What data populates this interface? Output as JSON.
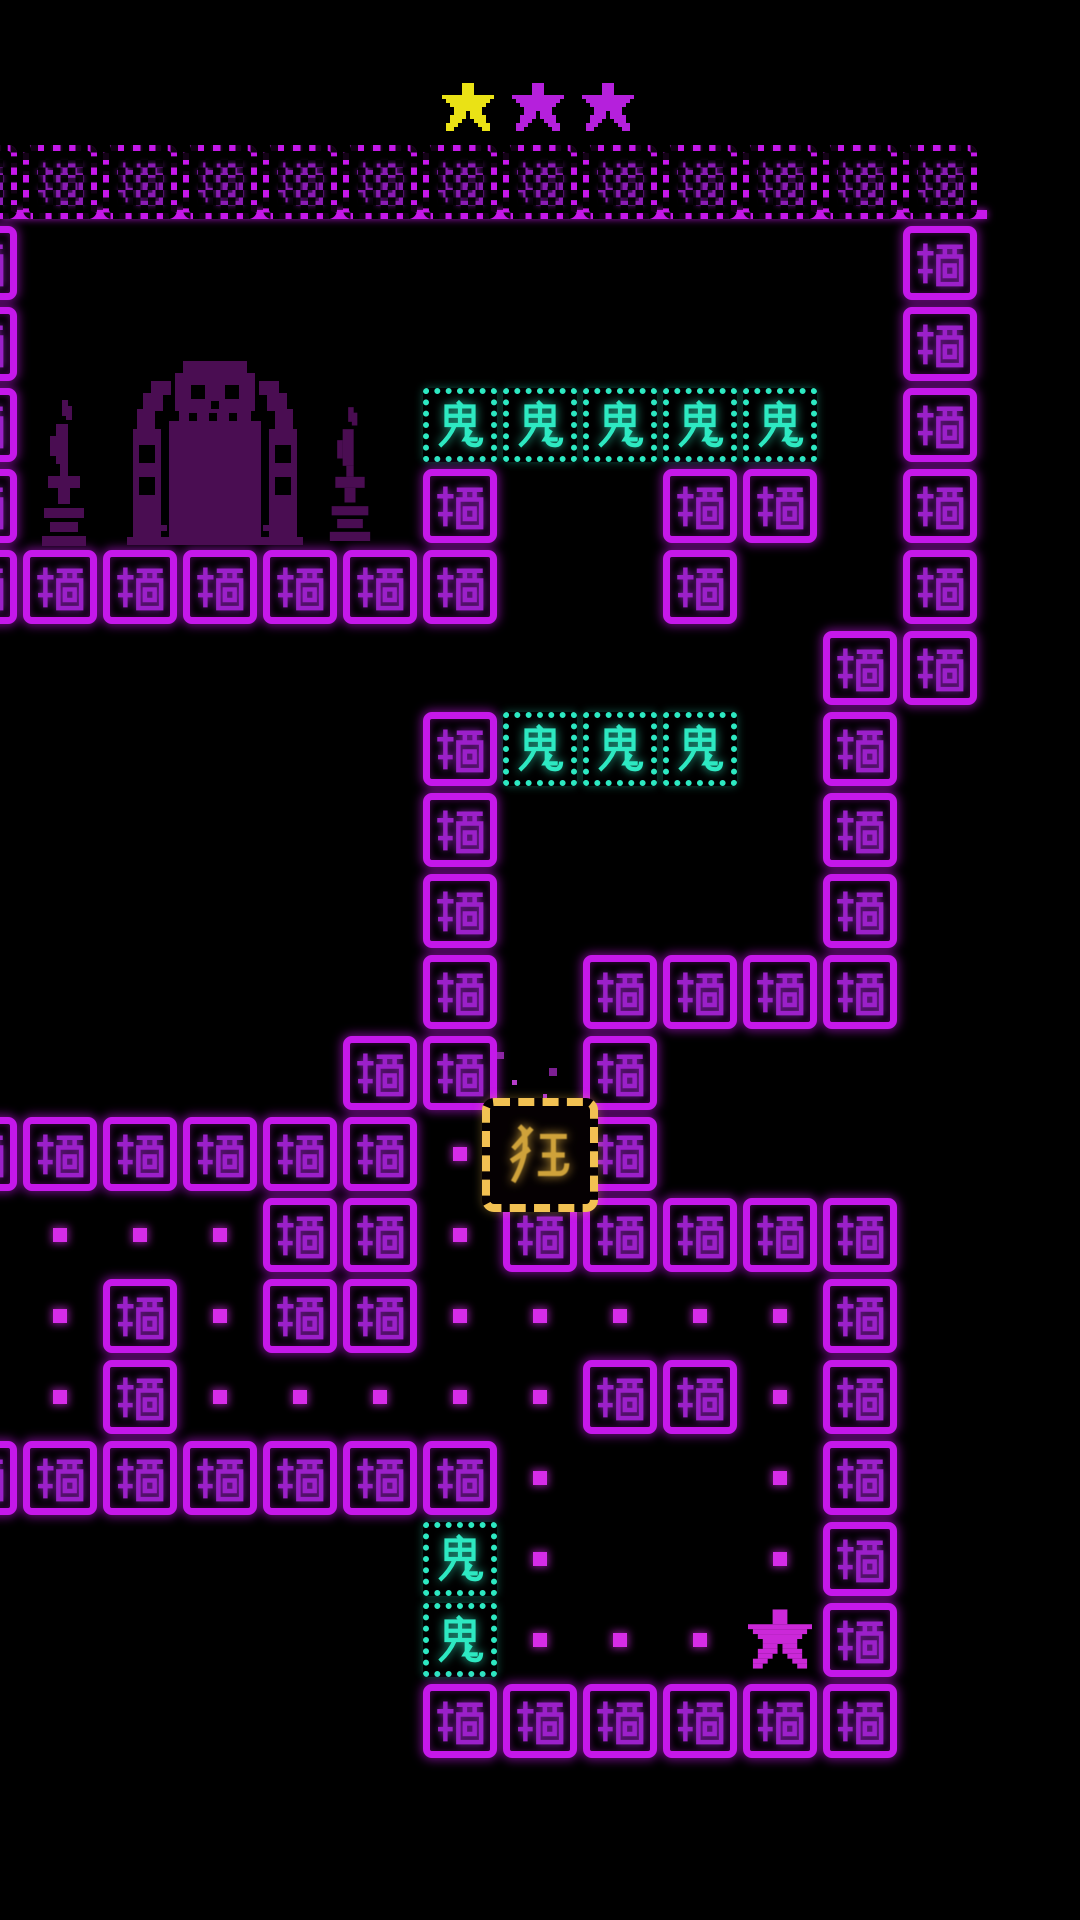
{
  "scene": {
    "background": "#000000",
    "viewport": {
      "width": 1080,
      "height": 1920
    }
  },
  "hud": {
    "stars": [
      {
        "id": "star-1",
        "state": "earned",
        "color": "#eae215"
      },
      {
        "id": "star-2",
        "state": "unearned",
        "color": "#b520dc"
      },
      {
        "id": "star-3",
        "state": "unearned",
        "color": "#b520dc"
      }
    ]
  },
  "board": {
    "glyphs": {
      "wall": "墙",
      "ghost": "鬼",
      "player": "狂"
    },
    "legend": {
      "W": "wall",
      "D": "wall-crumbled",
      "G": "ghost",
      ".": "pellet",
      "*": "star-pickup",
      " ": "empty"
    },
    "grid": {
      "cols": 13,
      "rows": 20,
      "tile": 74,
      "pitch_x": 80,
      "pitch_y": 81,
      "origin_x": -57,
      "origin_y": 145
    },
    "tilemap": [
      "DDDDDDDDDDDDD",
      "W           W",
      "W           W",
      "W     GGGGG W",
      "W     W  WW W",
      "WWWWWWW  W  W",
      "           WW",
      "      WGGG W ",
      "      W    W ",
      "      W    W ",
      "      W WWWW ",
      "     WW W    ",
      "WWWWWW. W    ",
      " ...WW.WWWWW ",
      " .W.WW.....W ",
      " .W.....WW.W ",
      "WWWWWWW.  .W ",
      "      G.  .W ",
      "      G...*W ",
      "      WWWWWW "
    ],
    "player": {
      "glyph": "狂",
      "col": 7,
      "row": 12,
      "x": 482,
      "y": 1098,
      "w": 116,
      "h": 114
    },
    "colors": {
      "wall_border": "#c518ea",
      "wall_glyph": "#9b20c9",
      "ghost": "#2de9c2",
      "pellet": "#d62ce8",
      "player_border": "#f2c152",
      "player_glyph": "#cfa23a",
      "pickup_star": "#cb28d8",
      "shrine": "#4a0d52"
    }
  },
  "decorations": {
    "shrine": {
      "x": 123,
      "y": 357,
      "w": 184,
      "h": 188
    },
    "candles": [
      {
        "x": 40,
        "y": 400,
        "w": 48,
        "h": 148
      },
      {
        "x": 328,
        "y": 402,
        "w": 44,
        "h": 146
      }
    ],
    "particles": [
      {
        "x": 497,
        "y": 1052,
        "s": 7,
        "c": "#8e24a6"
      },
      {
        "x": 512,
        "y": 1080,
        "s": 5,
        "c": "#b63ec9"
      },
      {
        "x": 549,
        "y": 1068,
        "s": 8,
        "c": "#7c1f92"
      },
      {
        "x": 543,
        "y": 1094,
        "s": 4,
        "c": "#b63ec9"
      }
    ]
  }
}
